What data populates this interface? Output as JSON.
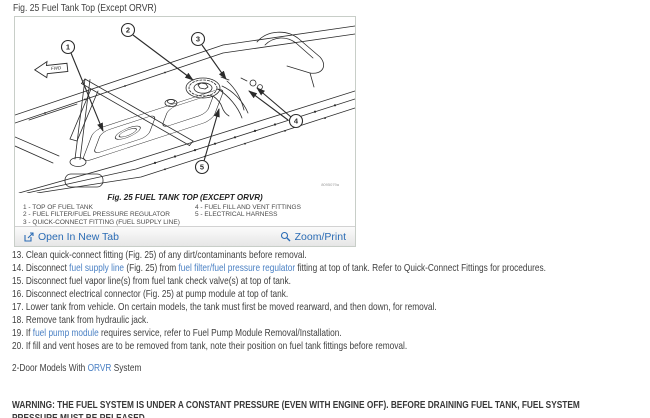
{
  "page": {
    "title": "Fig. 25 Fuel Tank Top (Except ORVR)"
  },
  "figure": {
    "caption": "Fig. 25 FUEL TANK TOP (EXCEPT ORVR)",
    "watermark": "8095079a",
    "fwd_label": "FWD",
    "callout_numbers": [
      "1",
      "2",
      "3",
      "4",
      "5"
    ],
    "legend_left": [
      "1 - TOP OF FUEL TANK",
      "2 - FUEL FILTER/FUEL PRESSURE REGULATOR",
      "3 - QUICK-CONNECT FITTING (FUEL SUPPLY LINE)"
    ],
    "legend_right": [
      "4 - FUEL FILL AND VENT FITTINGS",
      "5 - ELECTRICAL HARNESS"
    ],
    "toolbar": {
      "open_label": "Open In New Tab",
      "zoom_print_label": "Zoom/Print"
    }
  },
  "steps": [
    {
      "num": "13.",
      "segments": [
        {
          "t": "Clean quick-connect fitting (Fig. 25) of any dirt/contaminants before removal."
        }
      ]
    },
    {
      "num": "14.",
      "segments": [
        {
          "t": "Disconnect "
        },
        {
          "t": "fuel supply line",
          "link": true
        },
        {
          "t": " (Fig. 25) from "
        },
        {
          "t": "fuel filter/fuel pressure regulator",
          "link": true
        },
        {
          "t": " fitting at top of tank. Refer to Quick-Connect Fittings for procedures."
        }
      ]
    },
    {
      "num": "15.",
      "segments": [
        {
          "t": "Disconnect fuel vapor line(s) from fuel tank check valve(s) at top of tank."
        }
      ]
    },
    {
      "num": "16.",
      "segments": [
        {
          "t": "Disconnect electrical connector (Fig. 25) at pump module at top of tank."
        }
      ]
    },
    {
      "num": "17.",
      "segments": [
        {
          "t": "Lower tank from vehicle. On certain models, the tank must first be moved rearward, and then down, for removal."
        }
      ]
    },
    {
      "num": "18.",
      "segments": [
        {
          "t": "Remove tank from hydraulic jack."
        }
      ]
    },
    {
      "num": "19.",
      "segments": [
        {
          "t": "If "
        },
        {
          "t": "fuel pump module",
          "link": true
        },
        {
          "t": " requires service, refer to Fuel Pump Module Removal/Installation."
        }
      ]
    },
    {
      "num": "20.",
      "segments": [
        {
          "t": "If fill and vent hoses are to be removed from tank, note their position on fuel tank fittings before removal."
        }
      ]
    }
  ],
  "subheading": {
    "segments": [
      {
        "t": "2-Door Models With "
      },
      {
        "t": "ORVR",
        "link": true
      },
      {
        "t": " System"
      }
    ]
  },
  "warning": {
    "text": "WARNING: THE FUEL SYSTEM IS UNDER A CONSTANT PRESSURE (EVEN WITH ENGINE OFF). BEFORE DRAINING FUEL TANK, FUEL SYSTEM PRESSURE MUST BE RELEASED."
  },
  "colors": {
    "inline_link": "#4a80c4",
    "toolbar_link": "#2b6cb5",
    "body_text": "#3f3f3f",
    "figure_border": "#c8cec8",
    "line_art": "#2b2b2b"
  }
}
